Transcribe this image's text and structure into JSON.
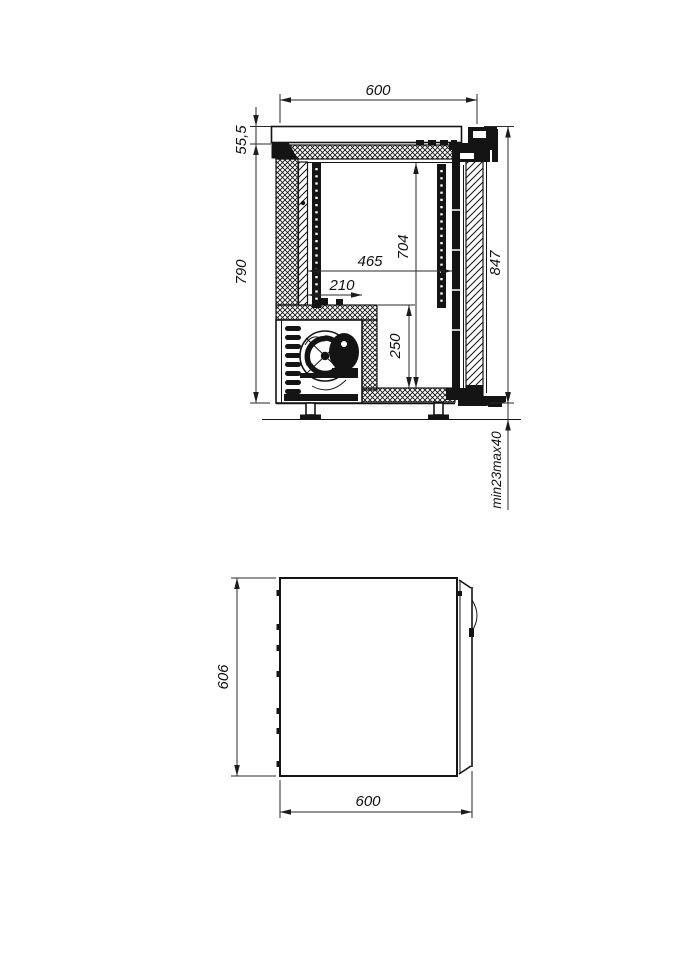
{
  "drawing": {
    "side_view": {
      "dims": {
        "top_width": "600",
        "counter_thickness": "55,5",
        "body_height": "790",
        "inner_height": "704",
        "inner_width": "465",
        "machine_width": "210",
        "machine_height": "250",
        "overall_height": "847",
        "foot_adjust": "min23max40"
      }
    },
    "plan_view": {
      "dims": {
        "depth": "606",
        "width": "600"
      }
    }
  }
}
